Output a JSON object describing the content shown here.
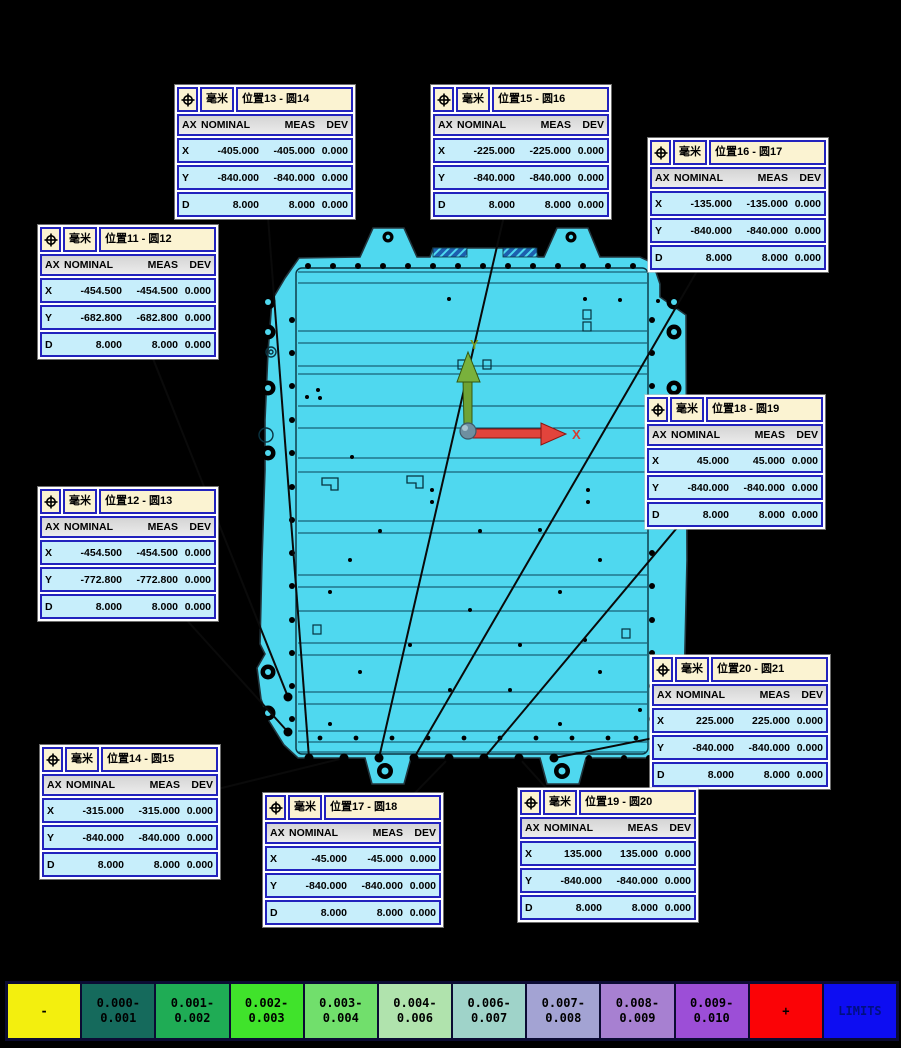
{
  "table": {
    "unit": "毫米",
    "columns": [
      "AX",
      "NOMINAL",
      "MEAS",
      "DEV"
    ],
    "symbol_name": "true-position-symbol"
  },
  "flags": [
    {
      "title": "位置13 - 圆14",
      "pos": {
        "left": 175,
        "top": 85
      },
      "anchor": {
        "x": 309,
        "y": 758
      },
      "rows": [
        [
          "X",
          "-405.000",
          "-405.000",
          "0.000"
        ],
        [
          "Y",
          "-840.000",
          "-840.000",
          "0.000"
        ],
        [
          "D",
          "8.000",
          "8.000",
          "0.000"
        ]
      ]
    },
    {
      "title": "位置15 - 圆16",
      "pos": {
        "left": 431,
        "top": 85
      },
      "anchor": {
        "x": 379,
        "y": 758
      },
      "rows": [
        [
          "X",
          "-225.000",
          "-225.000",
          "0.000"
        ],
        [
          "Y",
          "-840.000",
          "-840.000",
          "0.000"
        ],
        [
          "D",
          "8.000",
          "8.000",
          "0.000"
        ]
      ]
    },
    {
      "title": "位置16 - 圆17",
      "pos": {
        "left": 648,
        "top": 138
      },
      "anchor": {
        "x": 414,
        "y": 758
      },
      "rows": [
        [
          "X",
          "-135.000",
          "-135.000",
          "0.000"
        ],
        [
          "Y",
          "-840.000",
          "-840.000",
          "0.000"
        ],
        [
          "D",
          "8.000",
          "8.000",
          "0.000"
        ]
      ]
    },
    {
      "title": "位置11 - 圆12",
      "pos": {
        "left": 38,
        "top": 225
      },
      "anchor": {
        "x": 288,
        "y": 697
      },
      "rows": [
        [
          "X",
          "-454.500",
          "-454.500",
          "0.000"
        ],
        [
          "Y",
          "-682.800",
          "-682.800",
          "0.000"
        ],
        [
          "D",
          "8.000",
          "8.000",
          "0.000"
        ]
      ]
    },
    {
      "title": "位置12 - 圆13",
      "pos": {
        "left": 38,
        "top": 487
      },
      "anchor": {
        "x": 288,
        "y": 732
      },
      "rows": [
        [
          "X",
          "-454.500",
          "-454.500",
          "0.000"
        ],
        [
          "Y",
          "-772.800",
          "-772.800",
          "0.000"
        ],
        [
          "D",
          "8.000",
          "8.000",
          "0.000"
        ]
      ]
    },
    {
      "title": "位置18 - 圆19",
      "pos": {
        "left": 645,
        "top": 395
      },
      "anchor": {
        "x": 484,
        "y": 758
      },
      "rows": [
        [
          "X",
          "45.000",
          "45.000",
          "0.000"
        ],
        [
          "Y",
          "-840.000",
          "-840.000",
          "0.000"
        ],
        [
          "D",
          "8.000",
          "8.000",
          "0.000"
        ]
      ]
    },
    {
      "title": "位置20 - 圆21",
      "pos": {
        "left": 650,
        "top": 655
      },
      "anchor": {
        "x": 554,
        "y": 758
      },
      "rows": [
        [
          "X",
          "225.000",
          "225.000",
          "0.000"
        ],
        [
          "Y",
          "-840.000",
          "-840.000",
          "0.000"
        ],
        [
          "D",
          "8.000",
          "8.000",
          "0.000"
        ]
      ]
    },
    {
      "title": "位置14 - 圆15",
      "pos": {
        "left": 40,
        "top": 745
      },
      "anchor": {
        "x": 344,
        "y": 758
      },
      "rows": [
        [
          "X",
          "-315.000",
          "-315.000",
          "0.000"
        ],
        [
          "Y",
          "-840.000",
          "-840.000",
          "0.000"
        ],
        [
          "D",
          "8.000",
          "8.000",
          "0.000"
        ]
      ]
    },
    {
      "title": "位置17 - 圆18",
      "pos": {
        "left": 263,
        "top": 793
      },
      "anchor": {
        "x": 449,
        "y": 758
      },
      "rows": [
        [
          "X",
          "-45.000",
          "-45.000",
          "0.000"
        ],
        [
          "Y",
          "-840.000",
          "-840.000",
          "0.000"
        ],
        [
          "D",
          "8.000",
          "8.000",
          "0.000"
        ]
      ]
    },
    {
      "title": "位置19 - 圆20",
      "pos": {
        "left": 518,
        "top": 788
      },
      "anchor": {
        "x": 519,
        "y": 758
      },
      "rows": [
        [
          "X",
          "135.000",
          "135.000",
          "0.000"
        ],
        [
          "Y",
          "-840.000",
          "-840.000",
          "0.000"
        ],
        [
          "D",
          "8.000",
          "8.000",
          "0.000"
        ]
      ]
    }
  ],
  "axes_triad": {
    "x_label": "X",
    "y_label": "Y",
    "x_color": "#d63c31",
    "y_color": "#7c9a1d"
  },
  "legend": {
    "cells": [
      {
        "label": "-",
        "color": "#f3ef0e"
      },
      {
        "label": "0.000-\n0.001",
        "color": "#156a5c"
      },
      {
        "label": "0.001-\n0.002",
        "color": "#1fac55"
      },
      {
        "label": "0.002-\n0.003",
        "color": "#40e32b"
      },
      {
        "label": "0.003-\n0.004",
        "color": "#71df6c"
      },
      {
        "label": "0.004-\n0.006",
        "color": "#b0e3ad"
      },
      {
        "label": "0.006-\n0.007",
        "color": "#9fd3c9"
      },
      {
        "label": "0.007-\n0.008",
        "color": "#a3a3d3"
      },
      {
        "label": "0.008-\n0.009",
        "color": "#a780d1"
      },
      {
        "label": "0.009-\n0.010",
        "color": "#9c4ed7"
      },
      {
        "label": "+",
        "color": "#fb0306"
      },
      {
        "label": "LIMITS",
        "color": "#0d0df2",
        "text_color": "#001080"
      }
    ]
  },
  "colors": {
    "flag_border": "#2222bd",
    "flag_header_bg": "#fbf3d2",
    "flag_row_bg": "#c7eefb",
    "part_fill": "#4fd8ef",
    "background": "#000000"
  }
}
